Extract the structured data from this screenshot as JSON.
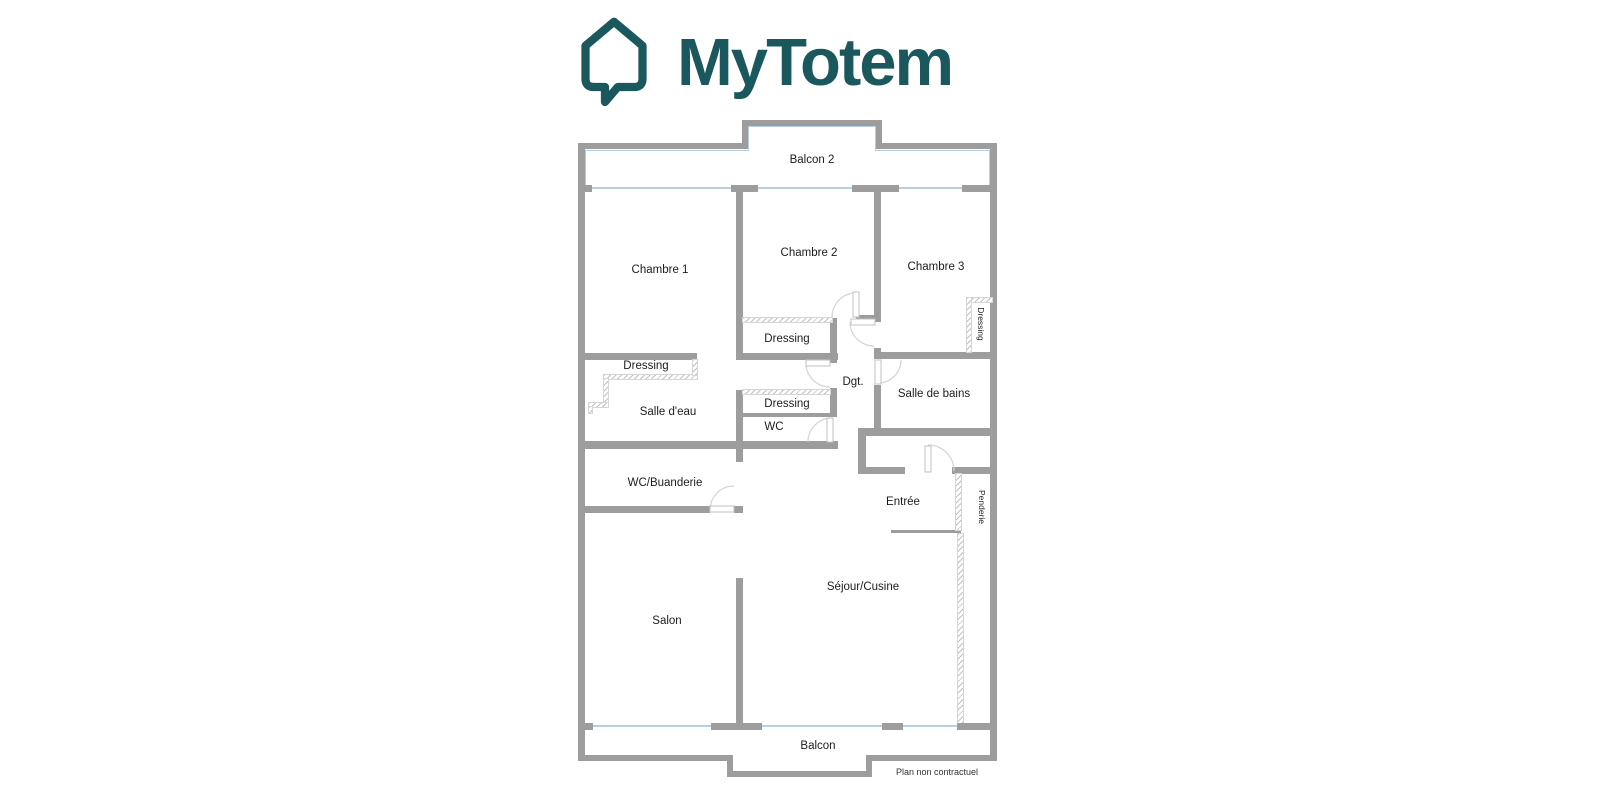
{
  "logo": {
    "brand": "MyTotem",
    "icon": "house-speech-bubble-icon",
    "accent_color": "#1a585e"
  },
  "plan": {
    "colors": {
      "wall": "#9d9d9d",
      "window": "#b7cfe3",
      "door_arc": "#d4d4d4",
      "hatch": "#c0c0c0"
    },
    "labels": [
      {
        "name": "balcon-2",
        "label": "Balcon 2"
      },
      {
        "name": "chambre-1",
        "label": "Chambre 1"
      },
      {
        "name": "chambre-2",
        "label": "Chambre 2"
      },
      {
        "name": "chambre-3",
        "label": "Chambre 3"
      },
      {
        "name": "dressing-chambre-2",
        "label": "Dressing"
      },
      {
        "name": "dressing-chambre-3",
        "label": "Dressing"
      },
      {
        "name": "dressing-salle-deau",
        "label": "Dressing"
      },
      {
        "name": "degagement",
        "label": "Dgt."
      },
      {
        "name": "salle-de-bains",
        "label": "Salle de bains"
      },
      {
        "name": "dressing-wc",
        "label": "Dressing"
      },
      {
        "name": "salle-deau",
        "label": "Salle d'eau"
      },
      {
        "name": "wc",
        "label": "WC"
      },
      {
        "name": "wc-buanderie",
        "label": "WC/Buanderie"
      },
      {
        "name": "entree",
        "label": "Entrée"
      },
      {
        "name": "penderie",
        "label": "Penderie"
      },
      {
        "name": "sejour-cuisine",
        "label": "Séjour/Cusine"
      },
      {
        "name": "salon",
        "label": "Salon"
      },
      {
        "name": "balcon",
        "label": "Balcon"
      }
    ],
    "footnote": "Plan non contractuel"
  }
}
